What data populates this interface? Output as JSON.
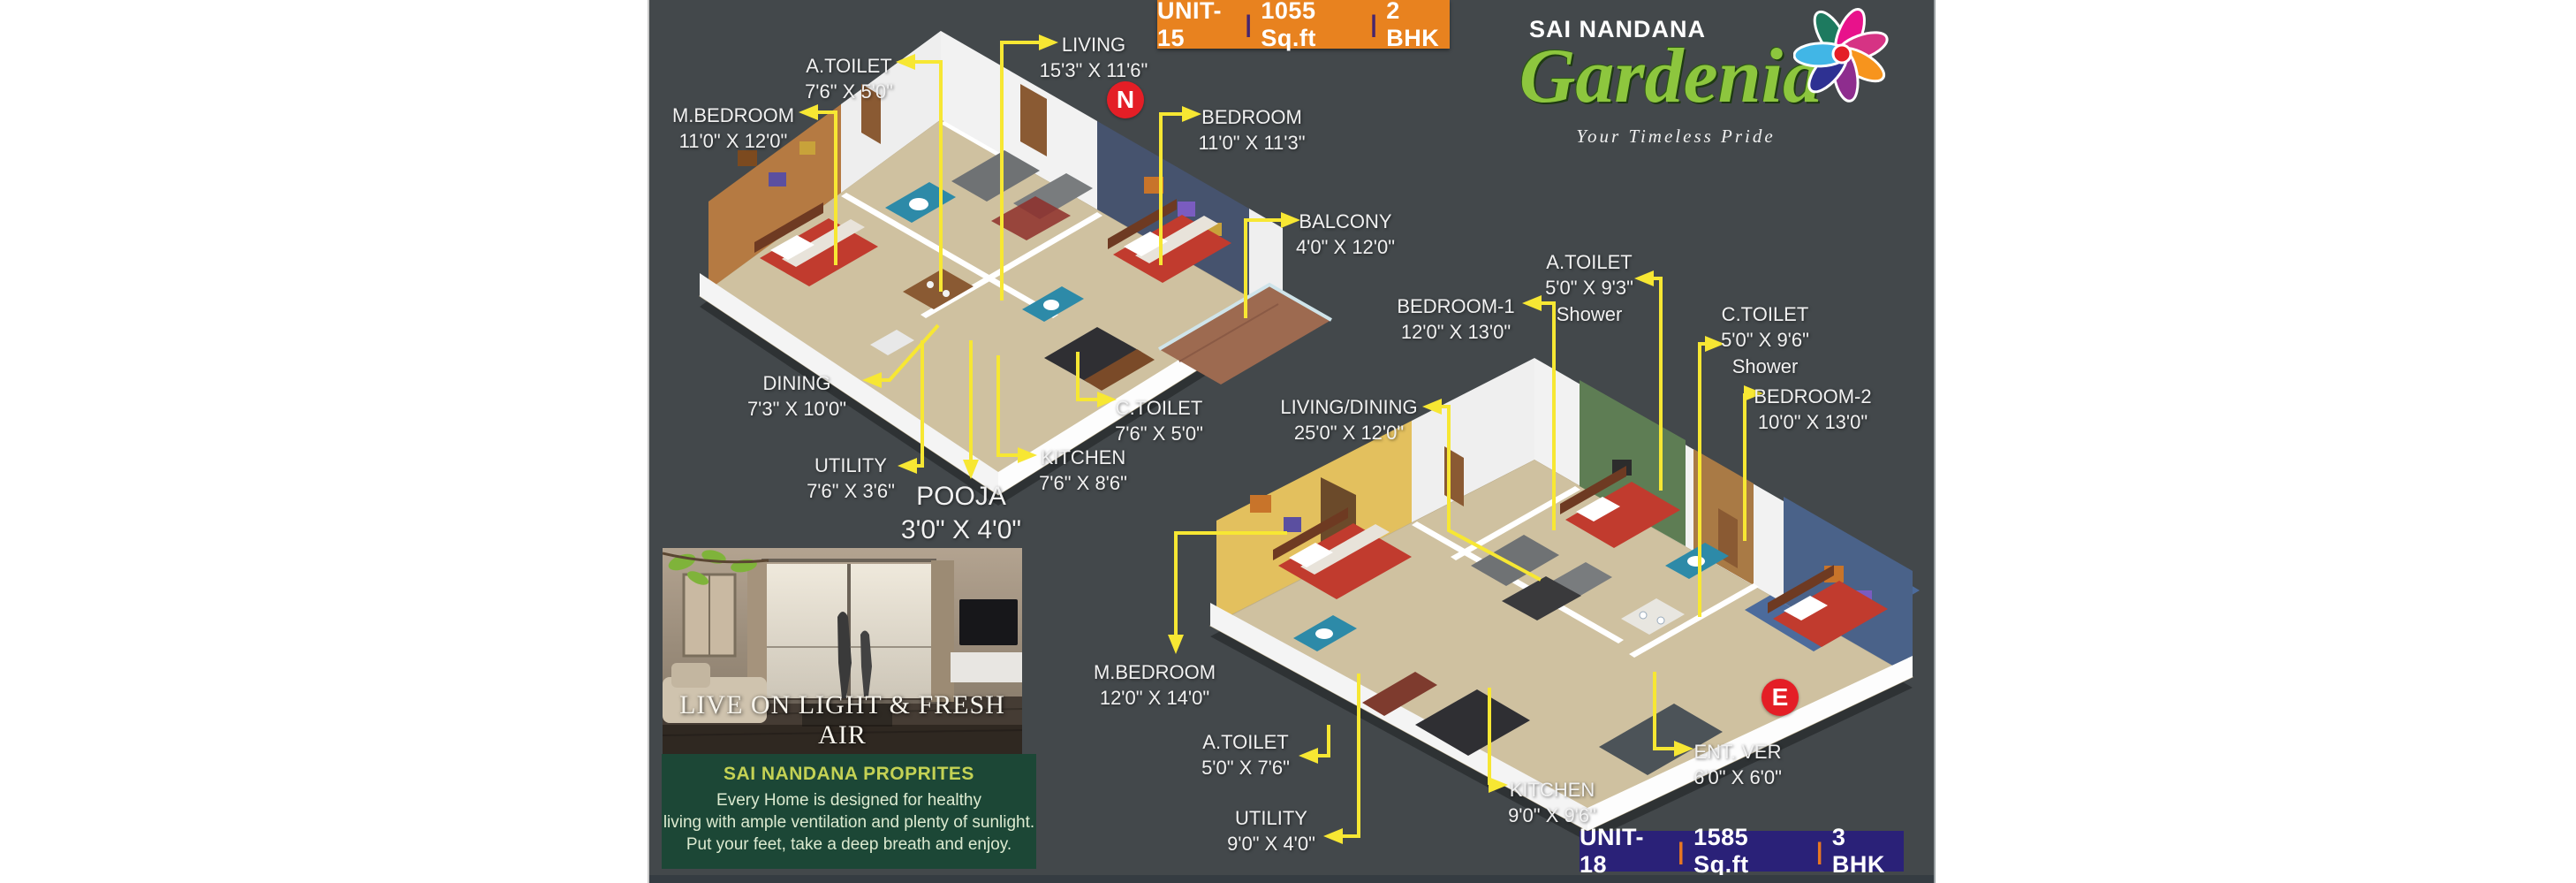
{
  "flyer": {
    "unit15_banner": {
      "unit": "UNIT-15",
      "sep": "|",
      "area": "1055 Sq.ft",
      "type": "2 BHK"
    },
    "unit18_banner": {
      "unit": "UNIT-18",
      "sep": "|",
      "area": "1585 Sq.ft",
      "type": "3 BHK"
    },
    "brand": {
      "name": "SAI NANDANA",
      "logo": "Gardenia",
      "tagline": "Your Timeless Pride"
    },
    "markers": {
      "north": "N",
      "east": "E"
    },
    "photo": {
      "caption": "LIVE ON LIGHT & FRESH AIR"
    },
    "info_box": {
      "heading": "SAI NANDANA PROPRITES",
      "lines": [
        "Every Home is designed for healthy",
        "living with ample ventilation and plenty of sunlight.",
        "Put your feet, take a deep breath and enjoy."
      ]
    },
    "plans": {
      "unit15": {
        "labels": [
          {
            "id": "living",
            "room": "LIVING",
            "dims": "15'3\" X 11'6\""
          },
          {
            "id": "a_toilet",
            "room": "A.TOILET",
            "dims": "7'6\" X 5'0\""
          },
          {
            "id": "m_bedroom",
            "room": "M.BEDROOM",
            "dims": "11'0\" X 12'0\""
          },
          {
            "id": "bedroom",
            "room": "BEDROOM",
            "dims": "11'0\" X 11'3\""
          },
          {
            "id": "balcony",
            "room": "BALCONY",
            "dims": "4'0\" X 12'0\""
          },
          {
            "id": "dining",
            "room": "DINING",
            "dims": "7'3\" X 10'0\""
          },
          {
            "id": "c_toilet",
            "room": "C.TOILET",
            "dims": "7'6\" X 5'0\""
          },
          {
            "id": "utility",
            "room": "UTILITY",
            "dims": "7'6\" X 3'6\""
          },
          {
            "id": "pooja",
            "room": "POOJA",
            "dims": "3'0\" X 4'0\""
          },
          {
            "id": "kitchen",
            "room": "KITCHEN",
            "dims": "7'6\" X 8'6\""
          }
        ]
      },
      "unit18": {
        "labels": [
          {
            "id": "a_toilet_top",
            "room": "A.TOILET",
            "dims": "5'0\" X 9'3\"",
            "note": "Shower"
          },
          {
            "id": "bedroom1",
            "room": "BEDROOM-1",
            "dims": "12'0\" X 13'0\""
          },
          {
            "id": "c_toilet",
            "room": "C.TOILET",
            "dims": "5'0\" X 9'6\"",
            "note": "Shower"
          },
          {
            "id": "bedroom2",
            "room": "BEDROOM-2",
            "dims": "10'0\" X 13'0\""
          },
          {
            "id": "living_dining",
            "room": "LIVING/DINING",
            "dims": "25'0\" X 12'0\""
          },
          {
            "id": "m_bedroom",
            "room": "M.BEDROOM",
            "dims": "12'0\" X 14'0\""
          },
          {
            "id": "a_toilet",
            "room": "A.TOILET",
            "dims": "5'0\" X 7'6\""
          },
          {
            "id": "utility",
            "room": "UTILITY",
            "dims": "9'0\" X 4'0\""
          },
          {
            "id": "kitchen",
            "room": "KITCHEN",
            "dims": "9'0\" X 9'6\""
          },
          {
            "id": "ent_ver",
            "room": "ENT. VER",
            "dims": "6'0\" X 6'0\""
          }
        ]
      }
    },
    "colors": {
      "background": "#43484b",
      "leader_yellow": "#f7e733",
      "banner_orange": "#e8821f",
      "banner_navy": "#2a2178",
      "marker_red": "#e41e26",
      "logo_green": "#8dc63e",
      "info_green": "#1c4736"
    }
  }
}
